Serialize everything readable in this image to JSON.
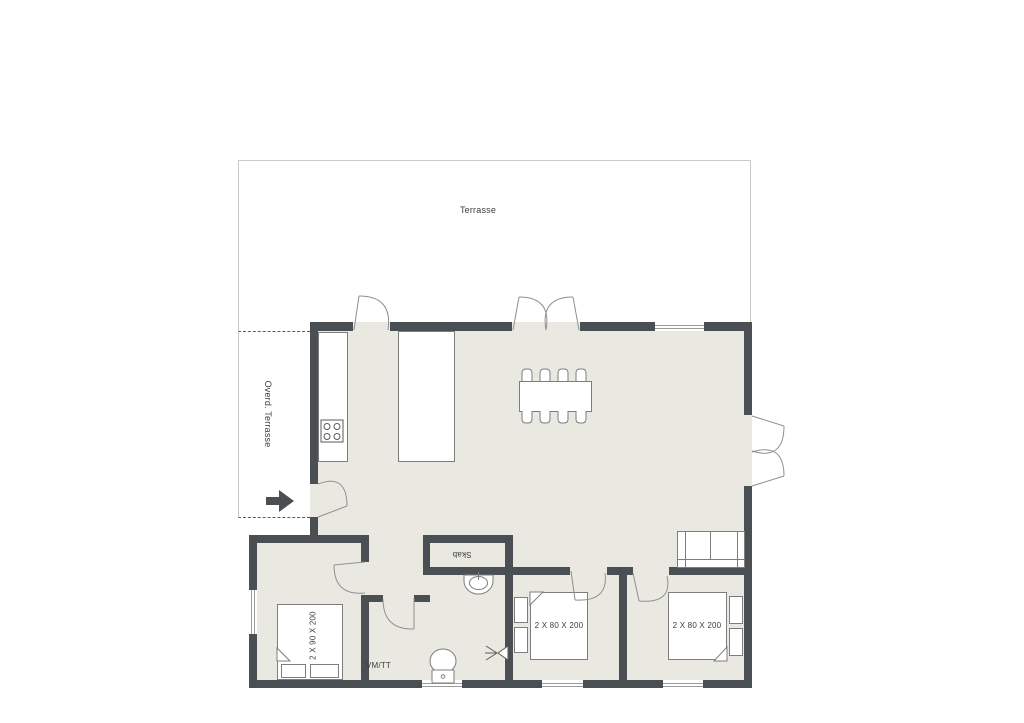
{
  "plan": {
    "terrace": {
      "label": "Terrasse"
    },
    "covered_terrace": {
      "label": "Overd. Terrasse"
    },
    "closet": {
      "label": "Skab"
    },
    "bathroom": {
      "washer_label": "VM/TT"
    },
    "bedroom_left": {
      "bed_size": "2 X 90 X 200"
    },
    "bedroom_middle": {
      "bed_size": "2 X 80 X 200"
    },
    "bedroom_right": {
      "bed_size": "2 X 80 X 200"
    }
  },
  "colors": {
    "wall": "#4a4f54",
    "floor": "#e9e9e2",
    "terrace_border": "#c9c9c9",
    "fixture_stroke": "#7d7d7d",
    "door_arc": "#8f8f8f",
    "text": "#3b3d40"
  }
}
